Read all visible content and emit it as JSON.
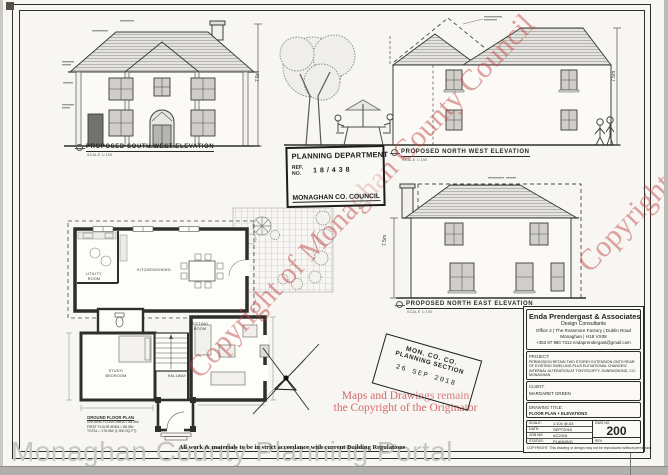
{
  "sheet": {
    "watermark_diagonal": "Copyright of Monaghan County Council",
    "watermark_bottom": "Monaghan County Planning Portal",
    "footer_note": "All work & materials to be in strict accordance with current Building Regulations"
  },
  "elevations": {
    "south_west": {
      "label": "PROPOSED SOUTH WEST ELEVATION",
      "scale": "SCALE 1:100",
      "height_dim": "7.5m"
    },
    "north_west": {
      "label": "PROPOSED NORTH WEST ELEVATION",
      "scale": "SCALE 1:100",
      "height_dim": "7.5m"
    },
    "north_east": {
      "label": "PROPOSED NORTH EAST ELEVATION",
      "scale": "SCALE 1:100",
      "height_dim": "7.5m"
    }
  },
  "floor_plan": {
    "rooms": {
      "kitchen_dining": "KITCHEN/DINING",
      "utility": "UTILITY ROOM",
      "sitting": "SITTING ROOM",
      "study": "STUDY/ BEDROOM",
      "hallway": "HALLWAY"
    },
    "caption_title": "GROUND FLOOR PLAN",
    "caption_lines": {
      "0": "GROUND FLOOR AREA = 88.3M²",
      "1": "FIRST FLOOR AREA = 88.3M²",
      "2": "TOTAL = 176.5M² (1,900 SQ.FT)"
    }
  },
  "stamps": {
    "planning_dept": {
      "title": "PLANNING DEPARTMENT",
      "ref_label": "REF.\nNO.",
      "ref_value": "18/438",
      "footer": "MONAGHAN CO. COUNCIL"
    },
    "received": {
      "line1": "MON. CO. CO.",
      "line2": "PLANNING SECTION",
      "date": "26 SEP 2018"
    }
  },
  "red_notice": {
    "line1": "Maps and Drawings remain",
    "line2": "the Copyright of the Originator",
    "color": "#d4696b"
  },
  "title_block": {
    "company": {
      "name": "Enda Prendergast & Associates",
      "subtitle": "Design Consultants",
      "address1": "Office 2 | The Rossmore Factory | Dublin Road",
      "address2": "Monaghan | H18 VX08",
      "contact": "+353 87 980 7312 endaprendergast@gmail.com"
    },
    "project": {
      "label": "PROJECT:",
      "text": "PERMISSION RETAIN TWO STOREY EXTENSION ONTO REAR OF EXISTING DWELLING PLUS ELEVATIONAL CHANGES/ INTERNAL ALTERATION AT TONYSCOFFY, DUNRAYMOND, CO. MONAGHAN"
    },
    "client": {
      "label": "CLIENT:",
      "text": "MARGARET GREEN"
    },
    "drawing_title": {
      "label": "DRAWING TITLE:",
      "text": "FLOOR PLAN + ELEVATIONS"
    },
    "meta": {
      "0": {
        "label": "SCALE:",
        "value": "1:100 @ A3"
      },
      "1": {
        "label": "DATE:",
        "value": "SEPT2018"
      },
      "2": {
        "label": "JOB NO:",
        "value": "AC2018"
      },
      "3": {
        "label": "STATUS:",
        "value": "PLANNING"
      }
    },
    "dwg": {
      "label": "DWG NO.",
      "value": "200",
      "rev_label": "REV."
    },
    "copyright": "COPYRIGHT: This drawing or design may not be reproduced without permission"
  }
}
